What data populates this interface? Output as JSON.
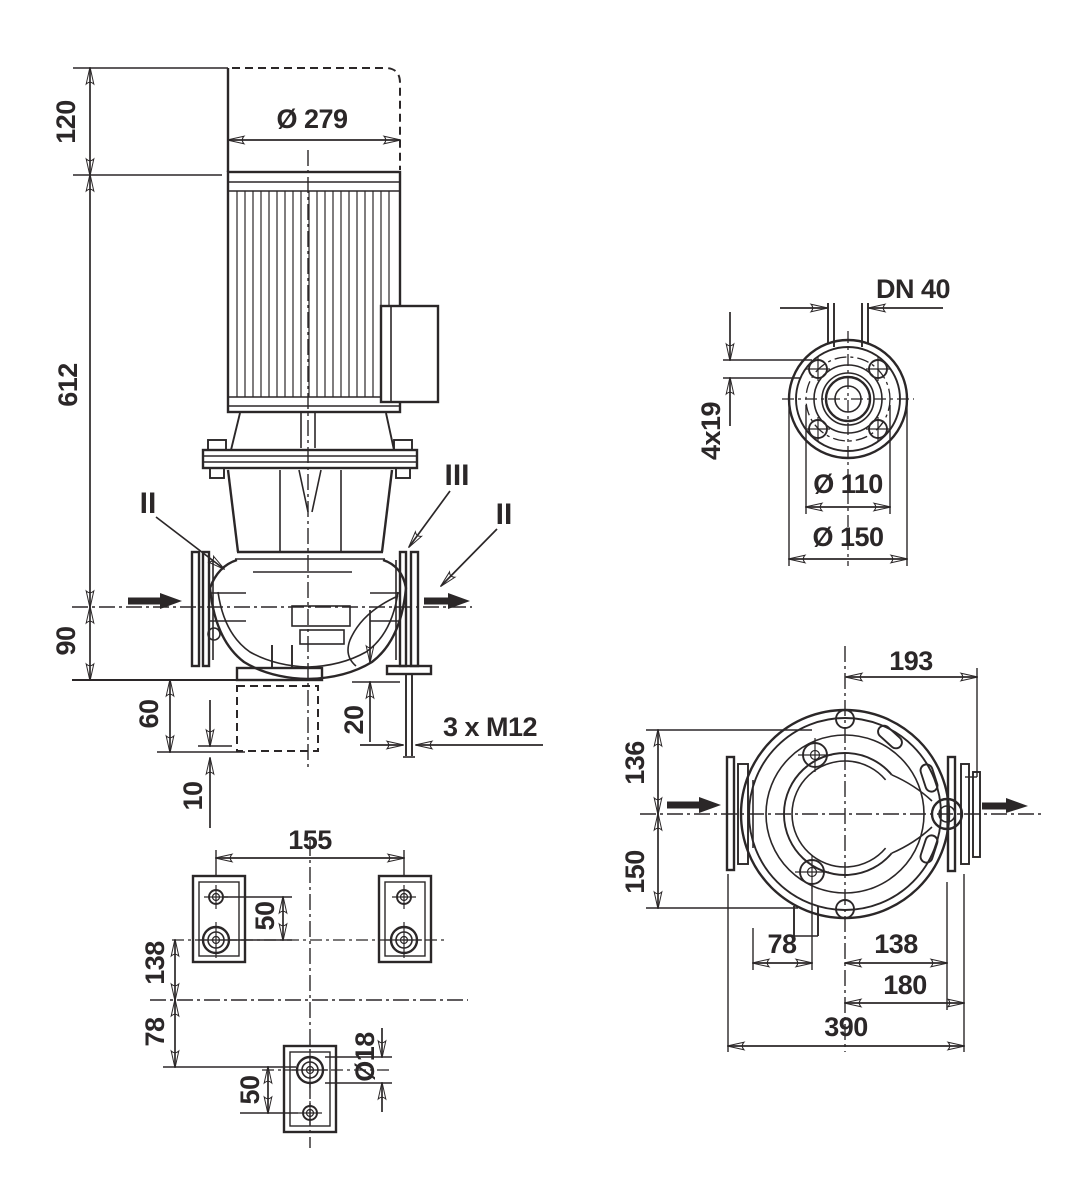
{
  "colors": {
    "ink": "#2b2728",
    "background": "#ffffff"
  },
  "front_view": {
    "dim_overhead": "120",
    "dim_height": "612",
    "dim_port_axis": "90",
    "dim_block_height": "60",
    "dim_grout": "10",
    "dim_flange_base": "20",
    "dim_motor_diameter": "Ø 279",
    "anchor_note": "3 x M12",
    "gauge_left": "II",
    "gauge_top": "III",
    "gauge_right": "II"
  },
  "flange_view": {
    "nominal_diameter": "DN 40",
    "bolt_holes": "4x19",
    "bolt_circle_diameter": "Ø 110",
    "outer_diameter": "Ø 150"
  },
  "top_view": {
    "dim_center_to_edge": "193",
    "dim_upper": "136",
    "dim_lower": "150",
    "dim_foot_offset": "78",
    "dim_center_foot": "138",
    "dim_center_flange": "180",
    "dim_port_to_port": "390"
  },
  "foot_view": {
    "dim_hole_spacing": "155",
    "dim_hole_offset_upper": "50",
    "dim_row_to_axis": "138",
    "dim_axis_to_foot": "78",
    "dim_hole_offset_lower": "50",
    "dim_hole_diameter": "Ø18"
  }
}
